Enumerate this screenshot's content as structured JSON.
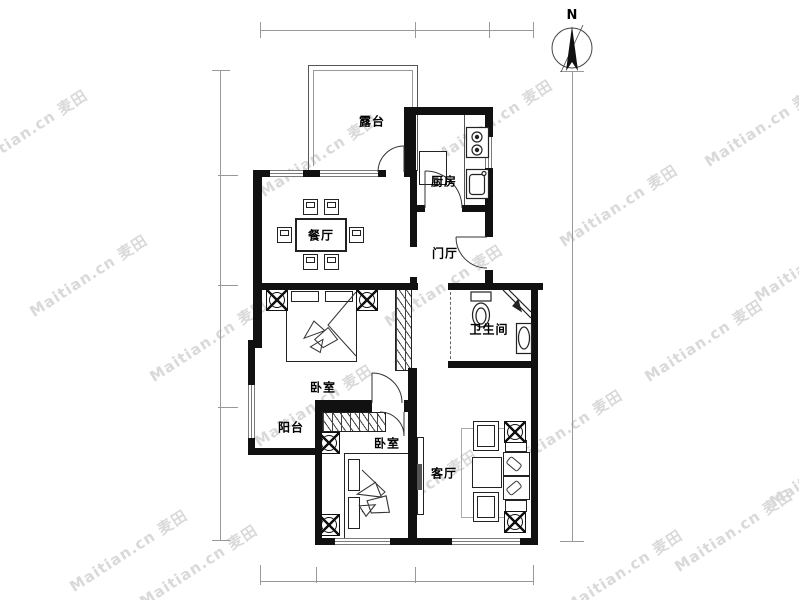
{
  "watermark": {
    "text": "Maitian.cn 麦田",
    "color": "#d9d9d9"
  },
  "compass": {
    "label": "N"
  },
  "labels": {
    "terrace": "露台",
    "kitchen": "厨房",
    "dining": "餐厅",
    "hall": "门厅",
    "bathroom": "卫生间",
    "bedroom_upper": "卧室",
    "balcony": "阳台",
    "bedroom_lower": "卧室",
    "living": "客厅"
  },
  "colors": {
    "wall": "#111111",
    "window_line": "#7a7a7a",
    "dimension_line": "#999999"
  }
}
